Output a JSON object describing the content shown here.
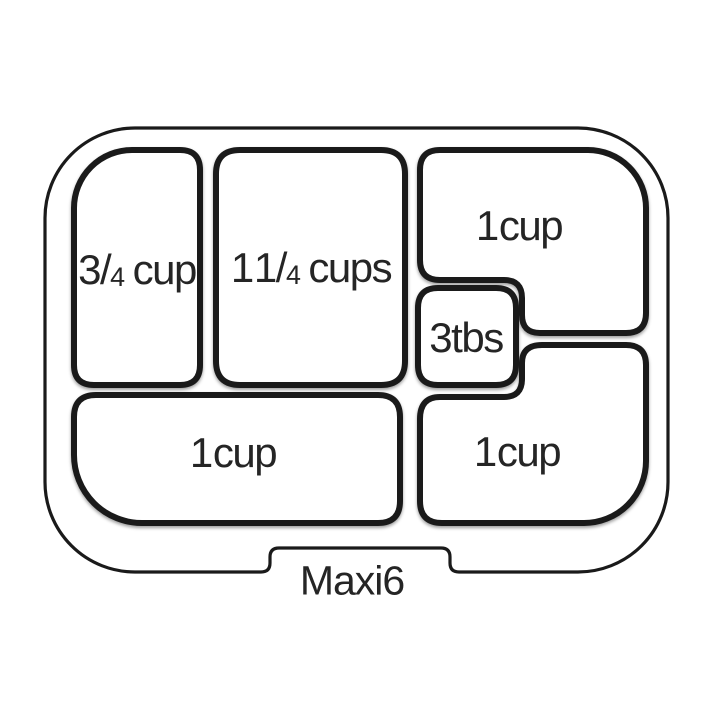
{
  "title": {
    "label": "Maxi6"
  },
  "compartments": [
    {
      "name": "top-left",
      "capacity": "3/4 cup",
      "pre": "3",
      "slash": "/",
      "sub": "4",
      "unit": "cup"
    },
    {
      "name": "top-middle",
      "capacity": "1 1/4 cups",
      "pre": "1 1",
      "slash": "/",
      "sub": "4",
      "unit": "cups"
    },
    {
      "name": "top-right",
      "capacity": "1 cup",
      "label": "1 cup"
    },
    {
      "name": "center-small",
      "capacity": "3tbs",
      "label": "3tbs"
    },
    {
      "name": "bottom-left",
      "capacity": "1 cup",
      "label": "1 cup"
    },
    {
      "name": "bottom-right",
      "capacity": "1 cup",
      "label": "1 cup"
    }
  ],
  "colors": {
    "outline": "#1a1a1a",
    "background": "#ffffff",
    "text": "#252525"
  }
}
